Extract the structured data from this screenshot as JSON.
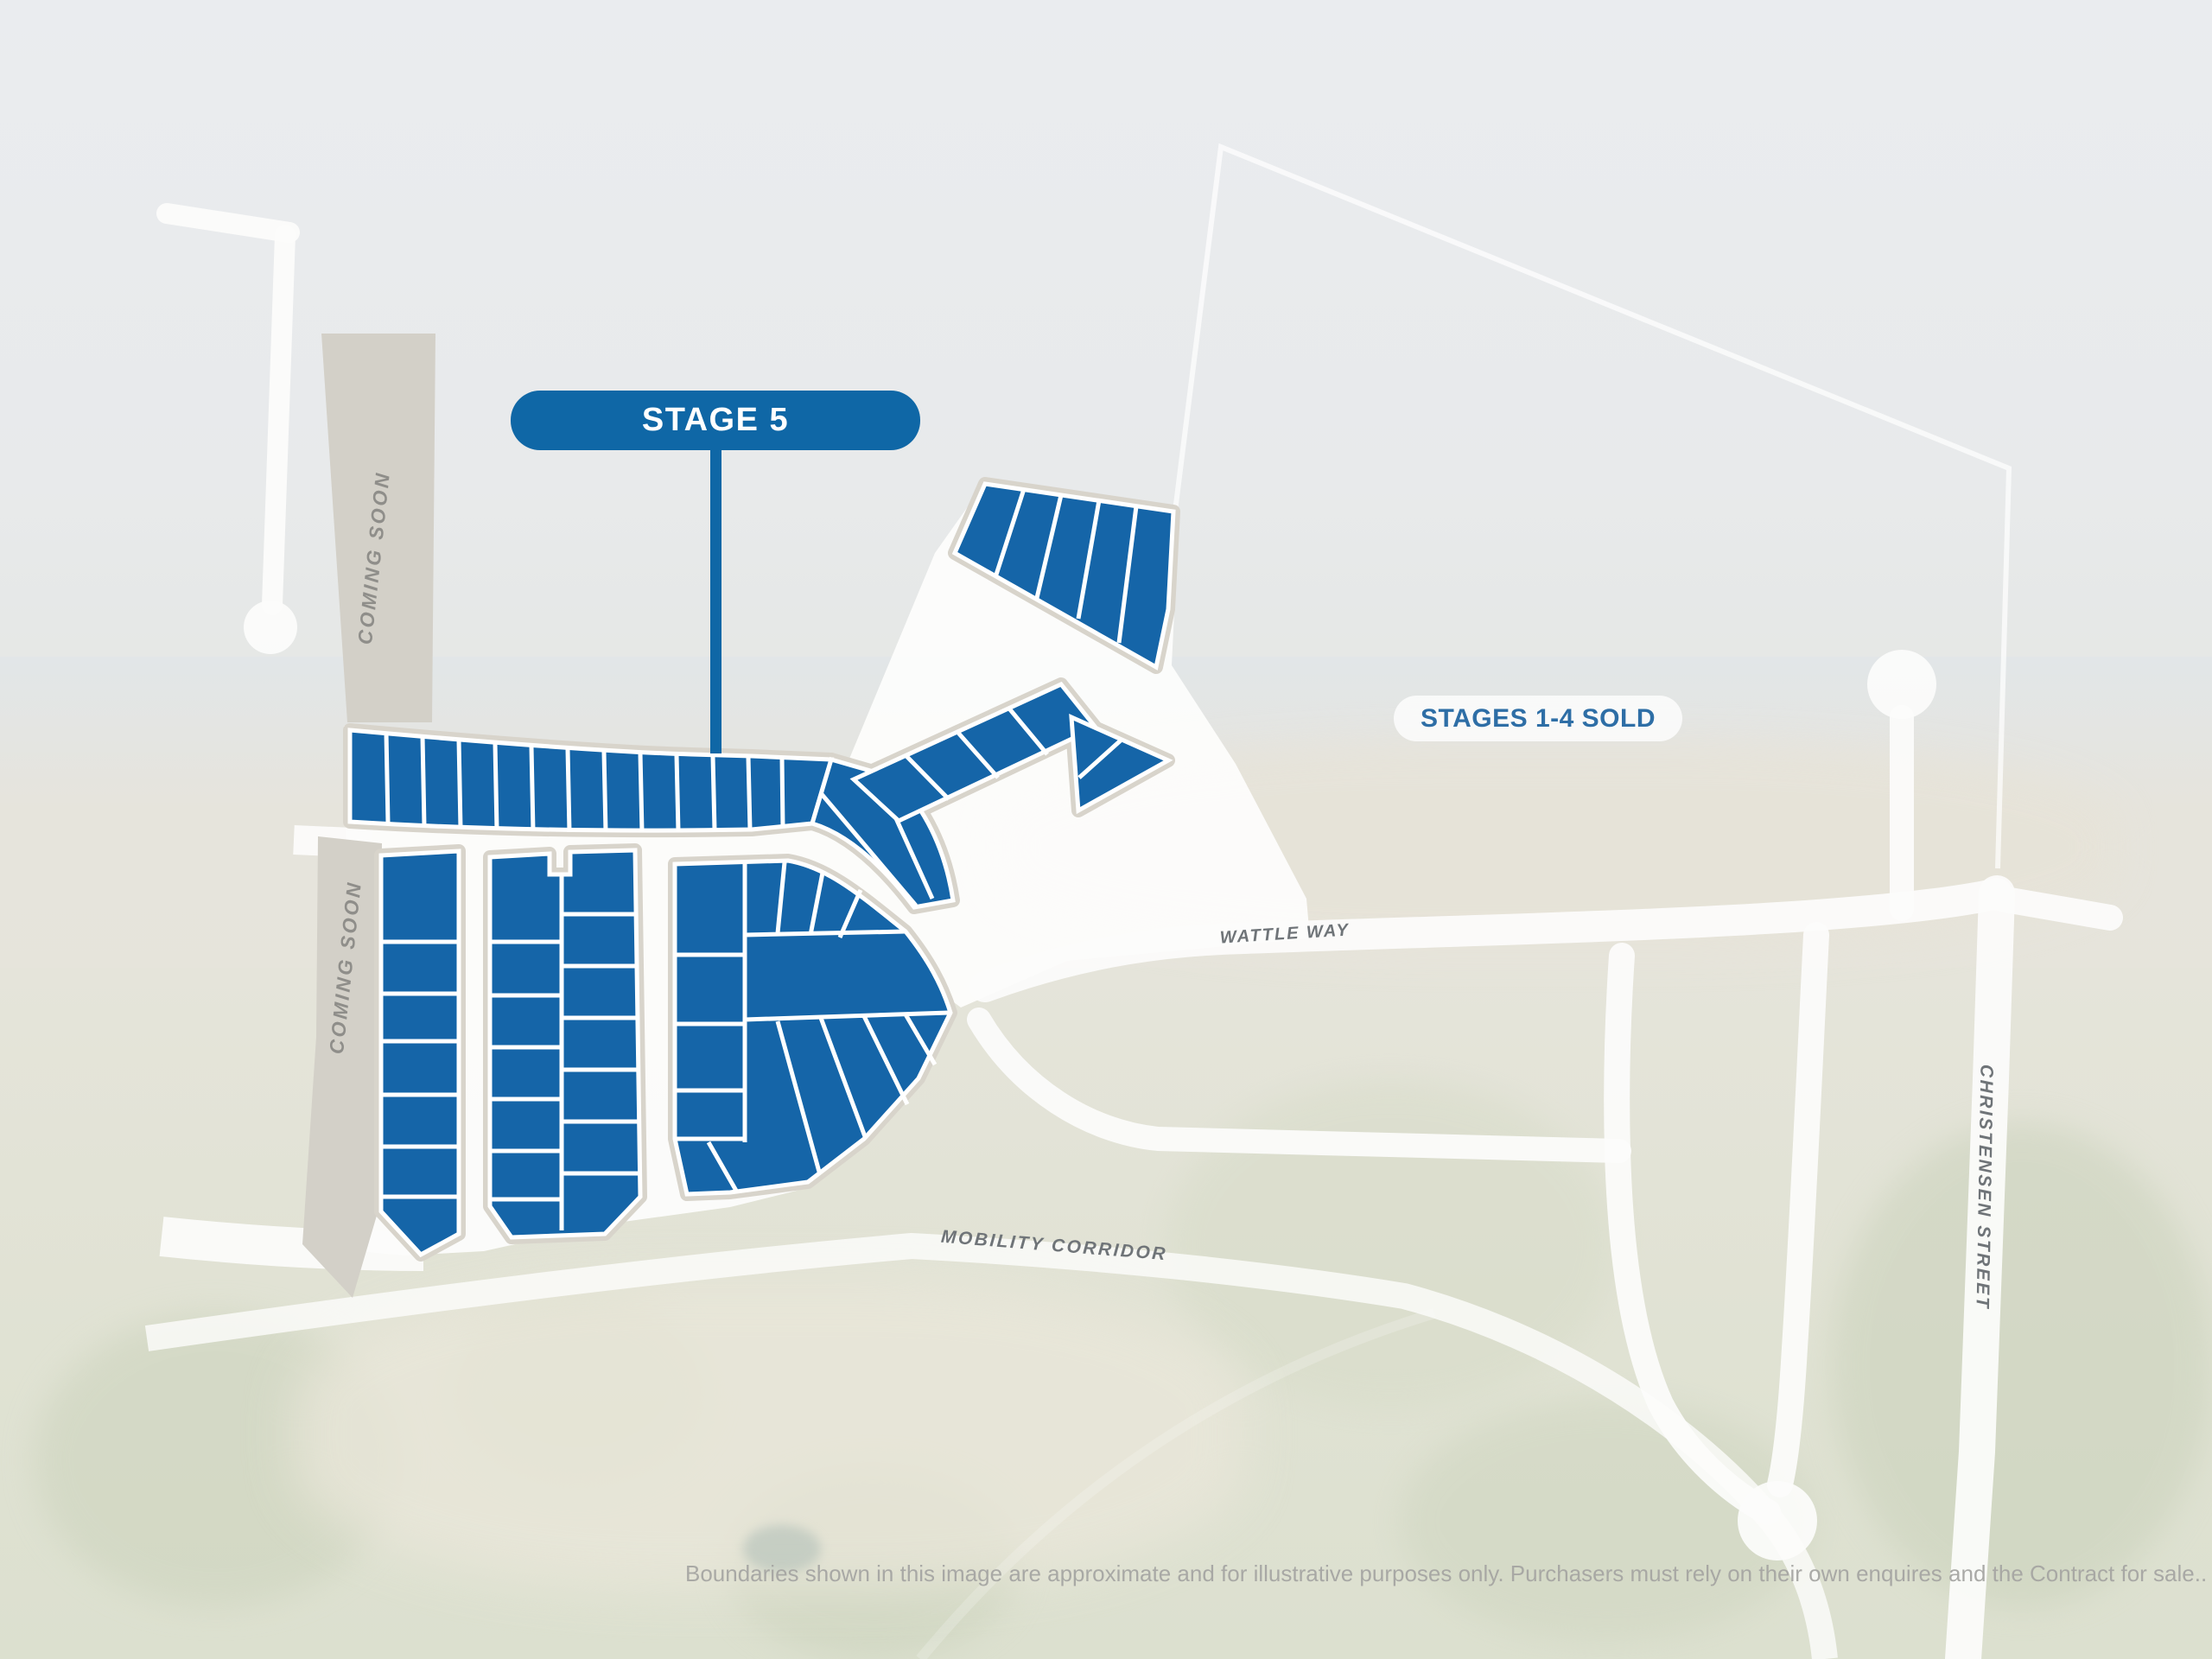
{
  "callouts": {
    "stage_pill": "STAGE 5",
    "sold_pill": "STAGES 1-4 SOLD"
  },
  "coming_soon": {
    "upper_strip": "COMING SOON",
    "lower_strip": "COMING SOON"
  },
  "streets": {
    "wattle": "WATTLE WAY",
    "mobility": "MOBILITY CORRIDOR",
    "christensen": "CHRISTENSEN STREET"
  },
  "disclaimer": "Boundaries shown in this image are approximate and for illustrative purposes only. Purchasers must rely on their own enquires and the Contract for sale..",
  "colors": {
    "lot_blue": "#1565a8",
    "stage_pill_blue": "#0f67a6",
    "sold_text_blue": "#2e6ea6",
    "road_white": "#fcfcfb",
    "verge_beige": "#d8d4cb",
    "coming_soon_strip": "#d3d0c8",
    "coming_soon_text": "#8f8e8a",
    "street_text": "#6f7478",
    "disclaimer_text": "#a6a6a3"
  }
}
